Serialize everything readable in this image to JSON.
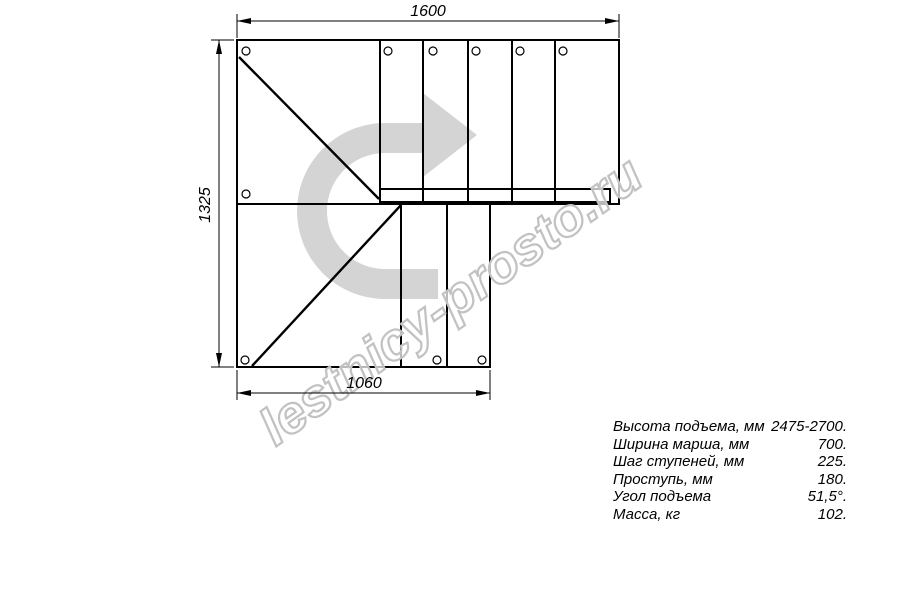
{
  "drawing": {
    "watermark": "lestnicy-prosto.ru",
    "dimensions": {
      "top": "1600",
      "left": "1325",
      "bottom": "1060"
    },
    "colors": {
      "line": "#000000",
      "background": "#ffffff",
      "direction_arrow": "#d4d4d4",
      "watermark_outline": "#c2c2c2"
    },
    "icons": {
      "direction_arrow": "curved-arrow-right"
    }
  },
  "specs": {
    "rows": [
      {
        "label": "Высота подъема, мм",
        "value": "2475-2700."
      },
      {
        "label": "Ширина марша, мм",
        "value": "700."
      },
      {
        "label": "Шаг ступеней, мм",
        "value": "225."
      },
      {
        "label": "Проступь, мм",
        "value": "180."
      },
      {
        "label": "Угол подъема",
        "value": "51,5°."
      },
      {
        "label": "Масса, кг",
        "value": "102."
      }
    ]
  }
}
